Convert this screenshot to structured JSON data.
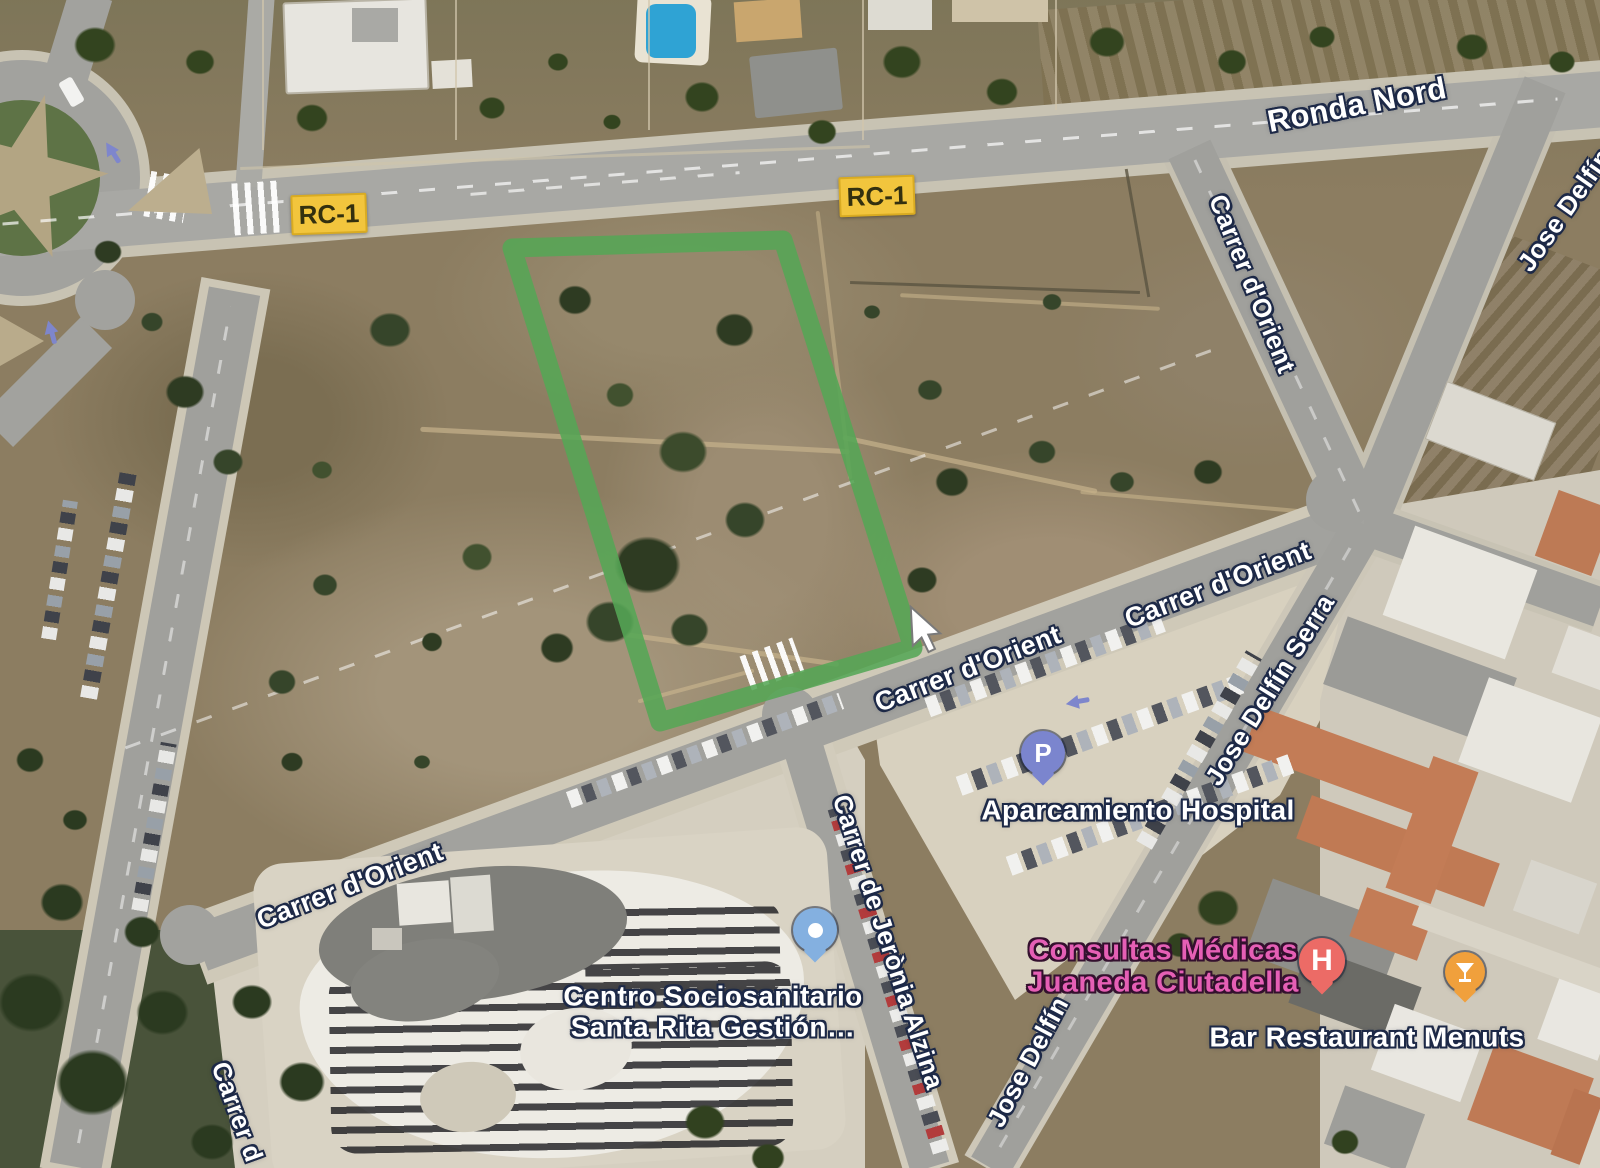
{
  "map_labels": {
    "ronda_nord": "Ronda Nord",
    "carrer_d_orient": "Carrer d'Orient",
    "jose_delfin": "Jose Delfín",
    "jose_delfin_serra": "Jose Delfín Serra",
    "carrer_de_jeronia_alzina": "Carrer de Jerònia Alzina",
    "carrer_d_partial": "Carrer d"
  },
  "road_badge": {
    "label": "RC-1",
    "bg_color": "#f2c53d"
  },
  "pois": {
    "aparcamiento_hospital": {
      "name": "Aparcamiento Hospital",
      "icon_letter": "P",
      "pin_color": "#7b85ce"
    },
    "centro_sociosanitario": {
      "name_line1": "Centro Sociosanitario",
      "name_line2": "Santa Rita Gestión…",
      "pin_color": "#84b0e0"
    },
    "consultas_medicas": {
      "name_line1": "Consultas Médicas",
      "name_line2": "Juaneda Ciutadella",
      "icon_letter": "H",
      "pin_color": "#ec6b66",
      "text_color": "#e55fb5"
    },
    "bar_restaurant_menuts": {
      "name": "Bar Restaurant Menuts",
      "pin_icon": "cocktail-glass",
      "pin_color": "#f0a03c"
    }
  },
  "overlay": {
    "plot_outline_color": "#55a655"
  }
}
